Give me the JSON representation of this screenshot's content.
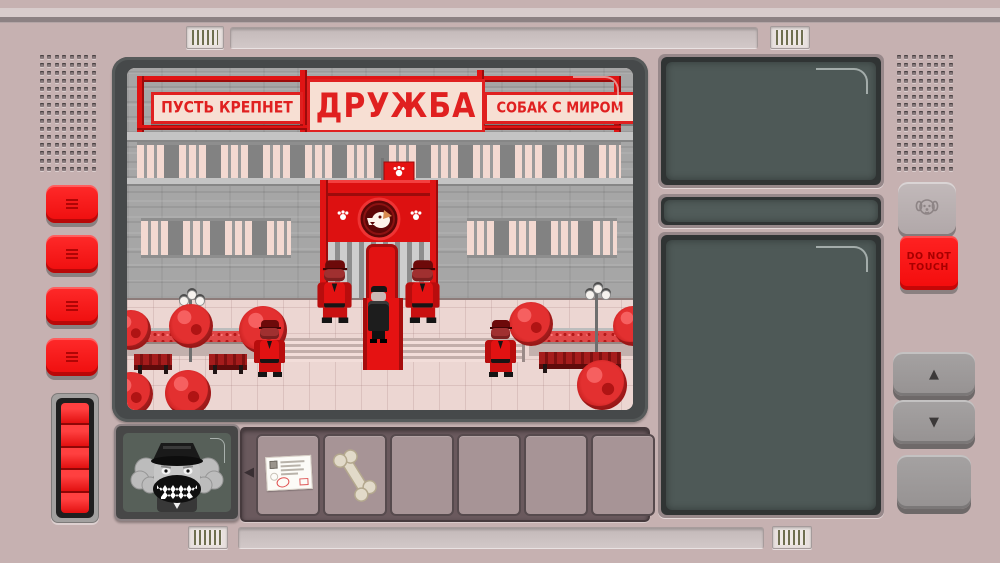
{
  "device": {
    "type": "dog-checkpoint-console"
  },
  "main_screen": {
    "banners": {
      "left": "ПУСТЬ КРЕПНЕТ",
      "center": "ДРУЖБА",
      "right": "СОБАК С МИРОМ"
    },
    "scene": {
      "building": "soviet-ministry-facade",
      "flag": "red-flag-with-white-paw",
      "emblem": "dog-head-medallion-with-paw-prints",
      "guards": 4,
      "visitor_in_black_coat": 1,
      "props": [
        "red-trees",
        "benches",
        "street-lamps",
        "flower-planters",
        "red-carpet",
        "steps"
      ]
    }
  },
  "portrait_panel": {
    "subject": "growling-dog-officer-portrait"
  },
  "inventory": {
    "slots": [
      {
        "item": "id-card"
      },
      {
        "item": "bone"
      },
      {
        "item": ""
      },
      {
        "item": ""
      },
      {
        "item": ""
      },
      {
        "item": ""
      }
    ]
  },
  "right_panel": {
    "top_screen": "",
    "ticker_slot": "",
    "bottom_screen": ""
  },
  "buttons": {
    "left_red_count": 4,
    "do_not_touch": {
      "line1": "DO NOT",
      "line2": "TOUCH"
    },
    "dog_button_icon": "dog-face-icon",
    "up": "▲",
    "down": "▼",
    "blank": ""
  },
  "icons": {
    "inv_prev": "◀",
    "inv_next": "▶",
    "flag_paw": "paw-print",
    "portico_paw": "paw-print"
  },
  "colors": {
    "body": "#c6b1b1",
    "accent_red": "#ee1111",
    "screen_glass": "#4e5957",
    "banner_bg": "#f7dfd3",
    "banner_text": "#e02020",
    "pavement": "#ecd6d2"
  }
}
